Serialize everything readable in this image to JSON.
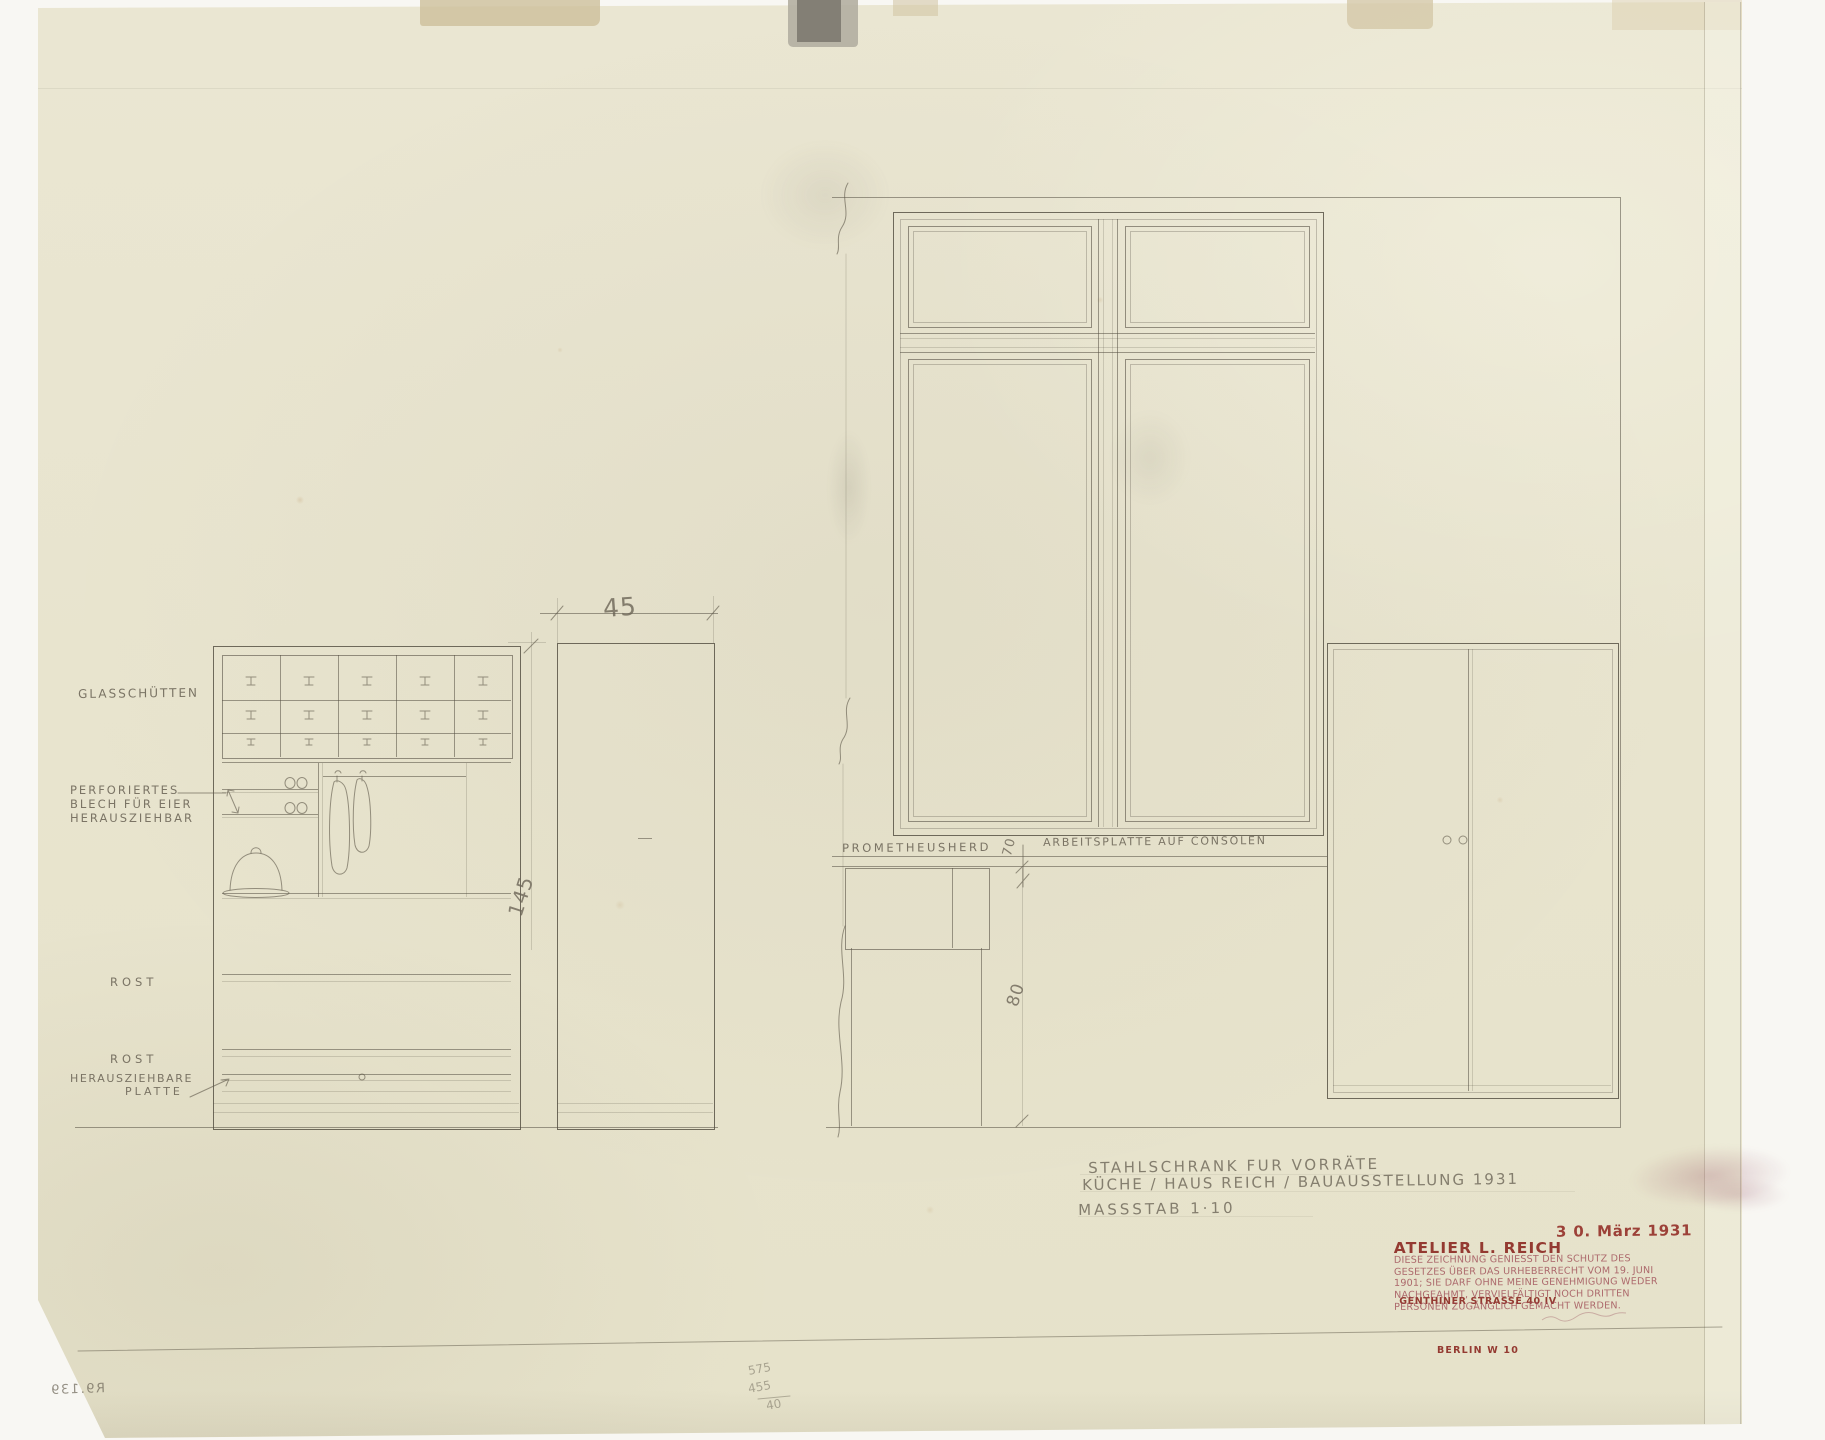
{
  "drawing": {
    "left_cabinet_labels": {
      "glasschuetten": "GLASSCHÜTTEN",
      "perforiertes_1": "PERFORIERTES",
      "perforiertes_2": "BLECH FÜR EIER",
      "perforiertes_3": "HERAUSZIEHBAR",
      "rost_upper": "ROST",
      "rost_lower": "ROST",
      "herauszieh_1": "HERAUSZIEHBARE",
      "herauszieh_2": "PLATTE"
    },
    "wall_labels": {
      "prometheusherd": "PROMETHEUSHERD",
      "arbeitsplatte": "ARBEITSPLATTE AUF CONSOLEN"
    },
    "dimensions": {
      "depth": "45",
      "height": "145",
      "worktop": "70",
      "stove": "80"
    }
  },
  "title_block": {
    "title_1": "STAHLSCHRANK FUR VORRÄTE",
    "title_2": "KÜCHE / HAUS REICH / BAUAUSSTELLUNG 1931",
    "scale": "MASSSTAB 1·10"
  },
  "stamps": {
    "atelier_1": "ATELIER L. REICH",
    "atelier_2": "GENTHINER STRASSE 40 IV",
    "atelier_3": "BERLIN W 10",
    "date": "3 0. März 1931",
    "copyright_1": "DIESE ZEICHNUNG GENIESST DEN SCHUTZ DES",
    "copyright_2": "GESETZES ÜBER DAS URHEBERRECHT VOM 19. JUNI",
    "copyright_3": "1901; SIE DARF OHNE MEINE GENEHMIGUNG WEDER",
    "copyright_4": "NACHGEAHMT, VERVIELFÄLTIGT NOCH DRITTEN",
    "copyright_5": "PERSONEN ZUGÄNGLICH GEMACHT WERDEN."
  },
  "margin_notes": {
    "inventory_mirrored": "R9.139",
    "calc_1": "575",
    "calc_2": "455",
    "calc_3": "40"
  },
  "colors": {
    "paper": "#e9e5d0",
    "pencil": "#6b6557",
    "stamp_red": "#8e3a32",
    "stamp_violet": "#a34e57"
  }
}
